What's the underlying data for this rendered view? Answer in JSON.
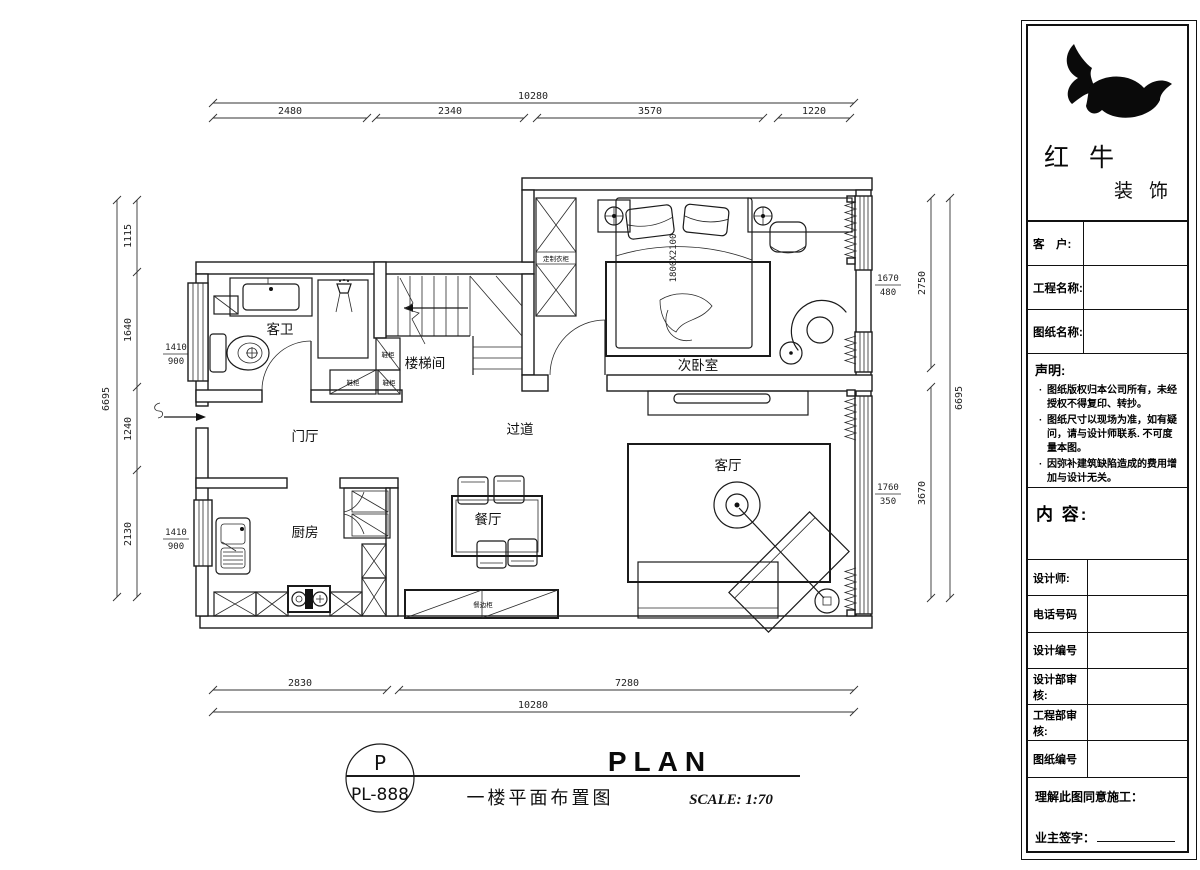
{
  "plan": {
    "room_labels": {
      "bathroom": "客卫",
      "stairwell": "楼梯间",
      "foyer": "门厅",
      "corridor": "过道",
      "kitchen": "厨房",
      "dining": "餐厅",
      "living": "客厅",
      "bedroom": "次卧室"
    },
    "furniture_labels": {
      "wardrobe": "定制衣柜",
      "shoe_cabinet": "鞋柜",
      "sideboard": "餐边柜",
      "bed_size": "1800X2100"
    }
  },
  "dimensions": {
    "top": {
      "total": "10280",
      "segments": [
        "2480",
        "2340",
        "3570",
        "1220"
      ]
    },
    "bottom": {
      "total": "10280",
      "segments": [
        "2830",
        "7280"
      ]
    },
    "left": {
      "total": "6695",
      "segments": [
        "1115",
        "1640",
        "1240",
        "2130"
      ],
      "window_upper": {
        "width": "1410",
        "height": "900"
      },
      "window_lower": {
        "width": "1410",
        "height": "900"
      }
    },
    "right": {
      "total": "6695",
      "segments": [
        "2750",
        "3670"
      ],
      "window_upper": {
        "width": "1670",
        "height": "480"
      },
      "window_lower": {
        "width": "1760",
        "height": "350"
      }
    }
  },
  "plan_title": {
    "code_letter": "P",
    "code_number": "PL-888",
    "title_en": "PLAN",
    "title_cn": "一楼平面布置图",
    "scale": "SCALE: 1:70"
  },
  "title_block": {
    "brand": {
      "line1": "红 牛",
      "line2": "装 饰"
    },
    "fields": [
      {
        "label": "客　户:"
      },
      {
        "label": "工程名称:"
      },
      {
        "label": "图纸名称:"
      }
    ],
    "statement": {
      "title": "声明:",
      "items": [
        "图纸版权归本公司所有，未经授权不得复印、转抄。",
        "图纸尺寸以现场为准，如有疑问，请与设计师联系. 不可度量本图。",
        "因弥补建筑缺陷造成的费用增加与设计无关。"
      ]
    },
    "content_label": "内 容:",
    "info_rows": [
      {
        "label": "设计师:"
      },
      {
        "label": "电话号码"
      },
      {
        "label": "设计编号"
      },
      {
        "label": "设计部审核:"
      },
      {
        "label": "工程部审核:"
      },
      {
        "label": "图纸编号"
      }
    ],
    "footer": {
      "line1": "理解此图同意施工：",
      "line2": "业主签字："
    }
  }
}
